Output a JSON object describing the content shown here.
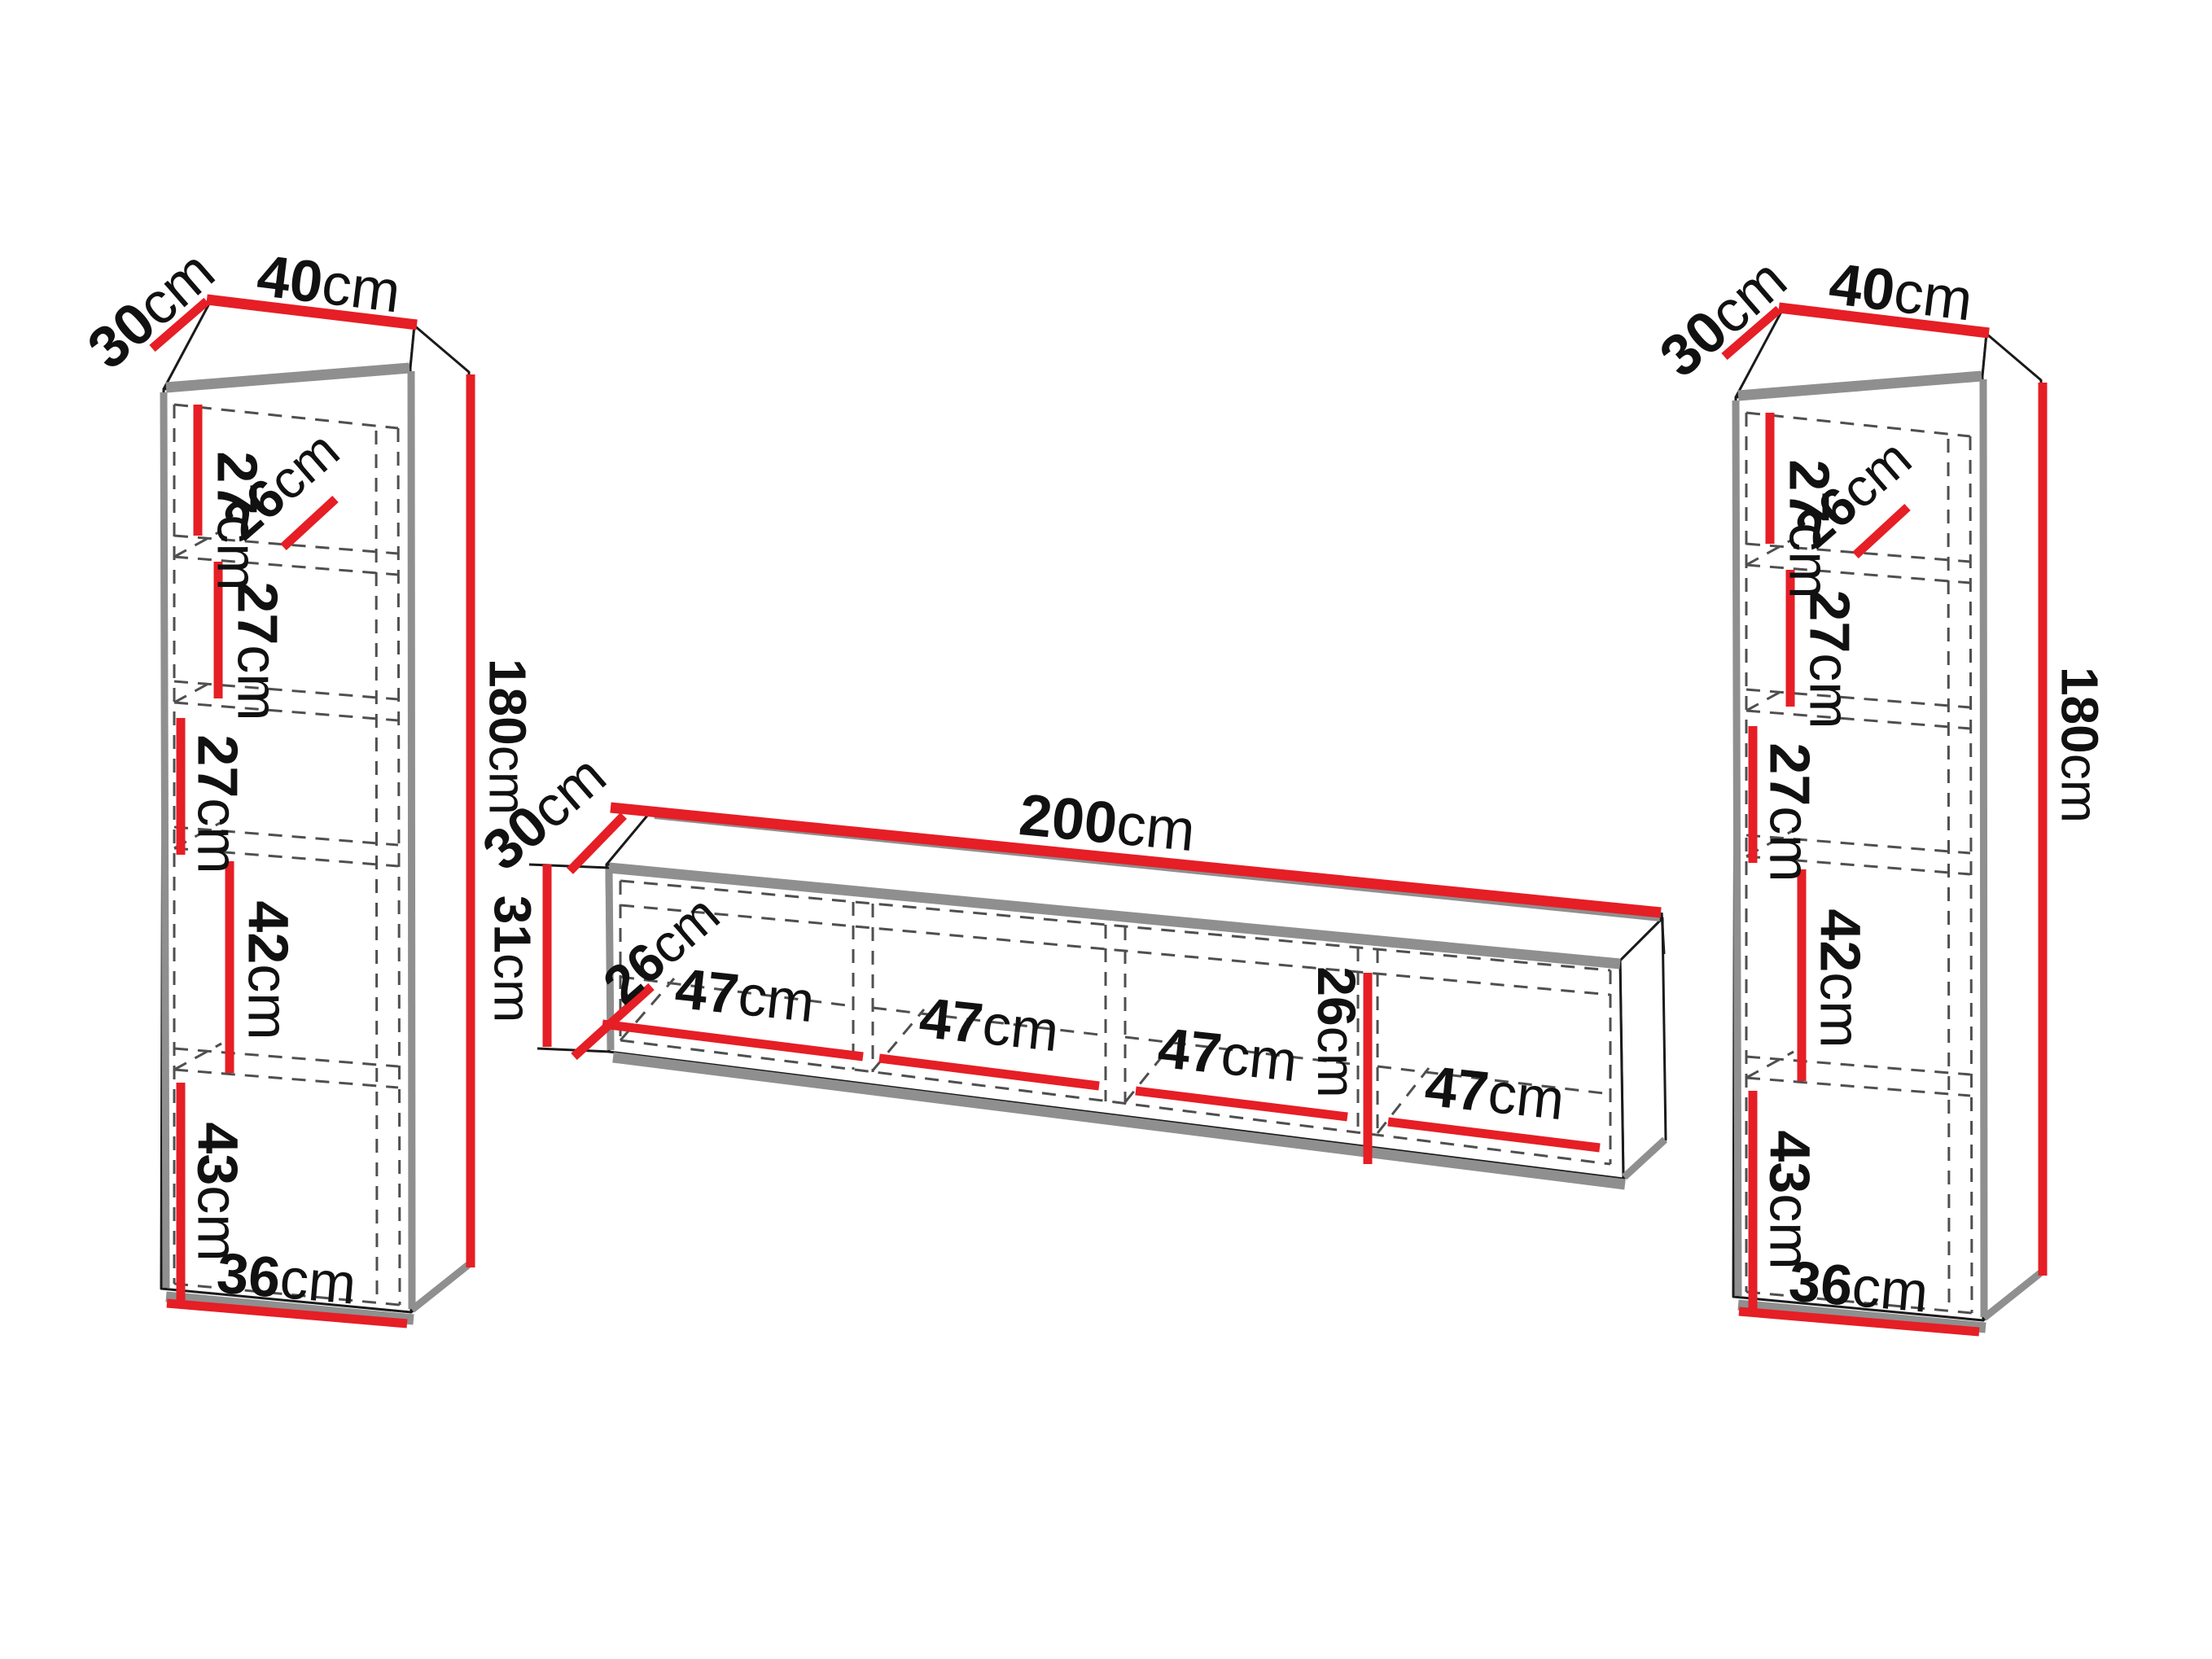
{
  "colors": {
    "dimension_red": "#e61e25",
    "outline_ink": "#1a1a1a",
    "shadow_gray": "#8f8f8f",
    "dash_gray": "#4f4f4f",
    "background": "#ffffff"
  },
  "left_cabinet": {
    "depth": {
      "v": "30",
      "u": "cm"
    },
    "width": {
      "v": "40",
      "u": "cm"
    },
    "height": {
      "v": "180",
      "u": "cm"
    },
    "shelf_1": {
      "v": "27",
      "u": "cm"
    },
    "inner_depth": {
      "v": "26",
      "u": "cm"
    },
    "shelf_2": {
      "v": "27",
      "u": "cm"
    },
    "shelf_3": {
      "v": "27",
      "u": "cm"
    },
    "shelf_4": {
      "v": "42",
      "u": "cm"
    },
    "shelf_5": {
      "v": "43",
      "u": "cm"
    },
    "inner_width": {
      "v": "36",
      "u": "cm"
    }
  },
  "tv_stand": {
    "depth": {
      "v": "30",
      "u": "cm"
    },
    "width": {
      "v": "200",
      "u": "cm"
    },
    "height": {
      "v": "31",
      "u": "cm"
    },
    "inner_depth": {
      "v": "26",
      "u": "cm"
    },
    "inner_height": {
      "v": "26",
      "u": "cm"
    },
    "bay_1": {
      "v": "47",
      "u": "cm"
    },
    "bay_2": {
      "v": "47",
      "u": "cm"
    },
    "bay_3": {
      "v": "47",
      "u": "cm"
    },
    "bay_4": {
      "v": "47",
      "u": "cm"
    }
  },
  "right_cabinet": {
    "depth": {
      "v": "30",
      "u": "cm"
    },
    "width": {
      "v": "40",
      "u": "cm"
    },
    "height": {
      "v": "180",
      "u": "cm"
    },
    "shelf_1": {
      "v": "27",
      "u": "cm"
    },
    "inner_depth": {
      "v": "26",
      "u": "cm"
    },
    "shelf_2": {
      "v": "27",
      "u": "cm"
    },
    "shelf_3": {
      "v": "27",
      "u": "cm"
    },
    "shelf_4": {
      "v": "42",
      "u": "cm"
    },
    "shelf_5": {
      "v": "43",
      "u": "cm"
    },
    "inner_width": {
      "v": "36",
      "u": "cm"
    }
  }
}
